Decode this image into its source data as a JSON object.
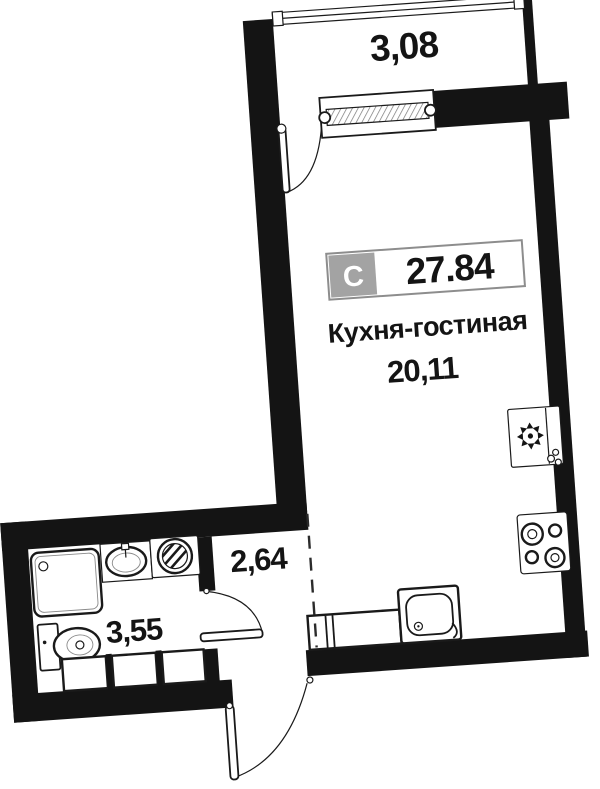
{
  "labels": {
    "balcony_area": "3,08",
    "type_letter": "С",
    "total_area": "27.84",
    "kitchen_living_name": "Кухня-гостиная",
    "kitchen_living_area": "20,11",
    "hallway_area": "2,64",
    "bathroom_area": "3,55"
  },
  "colors": {
    "wall": "#141414",
    "line": "#1a1a1a",
    "badge_fill": "#a3a3a3",
    "badge_border": "#8d8d8d",
    "background": "#ffffff"
  },
  "icons": {
    "fridge-icon": "square with snowflake symbol",
    "stove-icon": "square with 4 burner rings",
    "washing-machine-icon": "square with hatched drum circle",
    "bath-sink-icon": "oval basin with tap",
    "shower-tray-icon": "square tray with drain",
    "toilet-icon": "tank and oval bowl",
    "kitchen-sink-icon": "rounded square basin with drain and tap",
    "window-icon": "double-line strip with end caps",
    "door-swing-icon": "leaf with quarter-circle arc",
    "zone-boundary-icon": "dashed line"
  }
}
